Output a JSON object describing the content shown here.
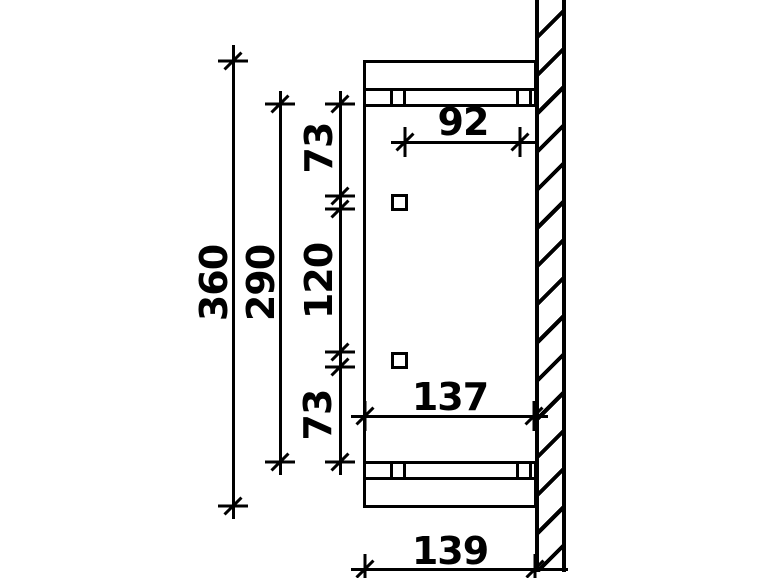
{
  "drawing": {
    "title": "canopy-side-view-technical-drawing",
    "background_color": "#ffffff",
    "line_color": "#000000",
    "annotations": {
      "height_total": {
        "label": "360"
      },
      "height_inner": {
        "label": "290"
      },
      "offset_top": {
        "label": "73"
      },
      "spacing_middle": {
        "label": "120"
      },
      "offset_bottom": {
        "label": "73"
      },
      "depth_top": {
        "label": "92"
      },
      "depth_lower": {
        "label": "137"
      },
      "depth_total": {
        "label": "139"
      }
    }
  }
}
